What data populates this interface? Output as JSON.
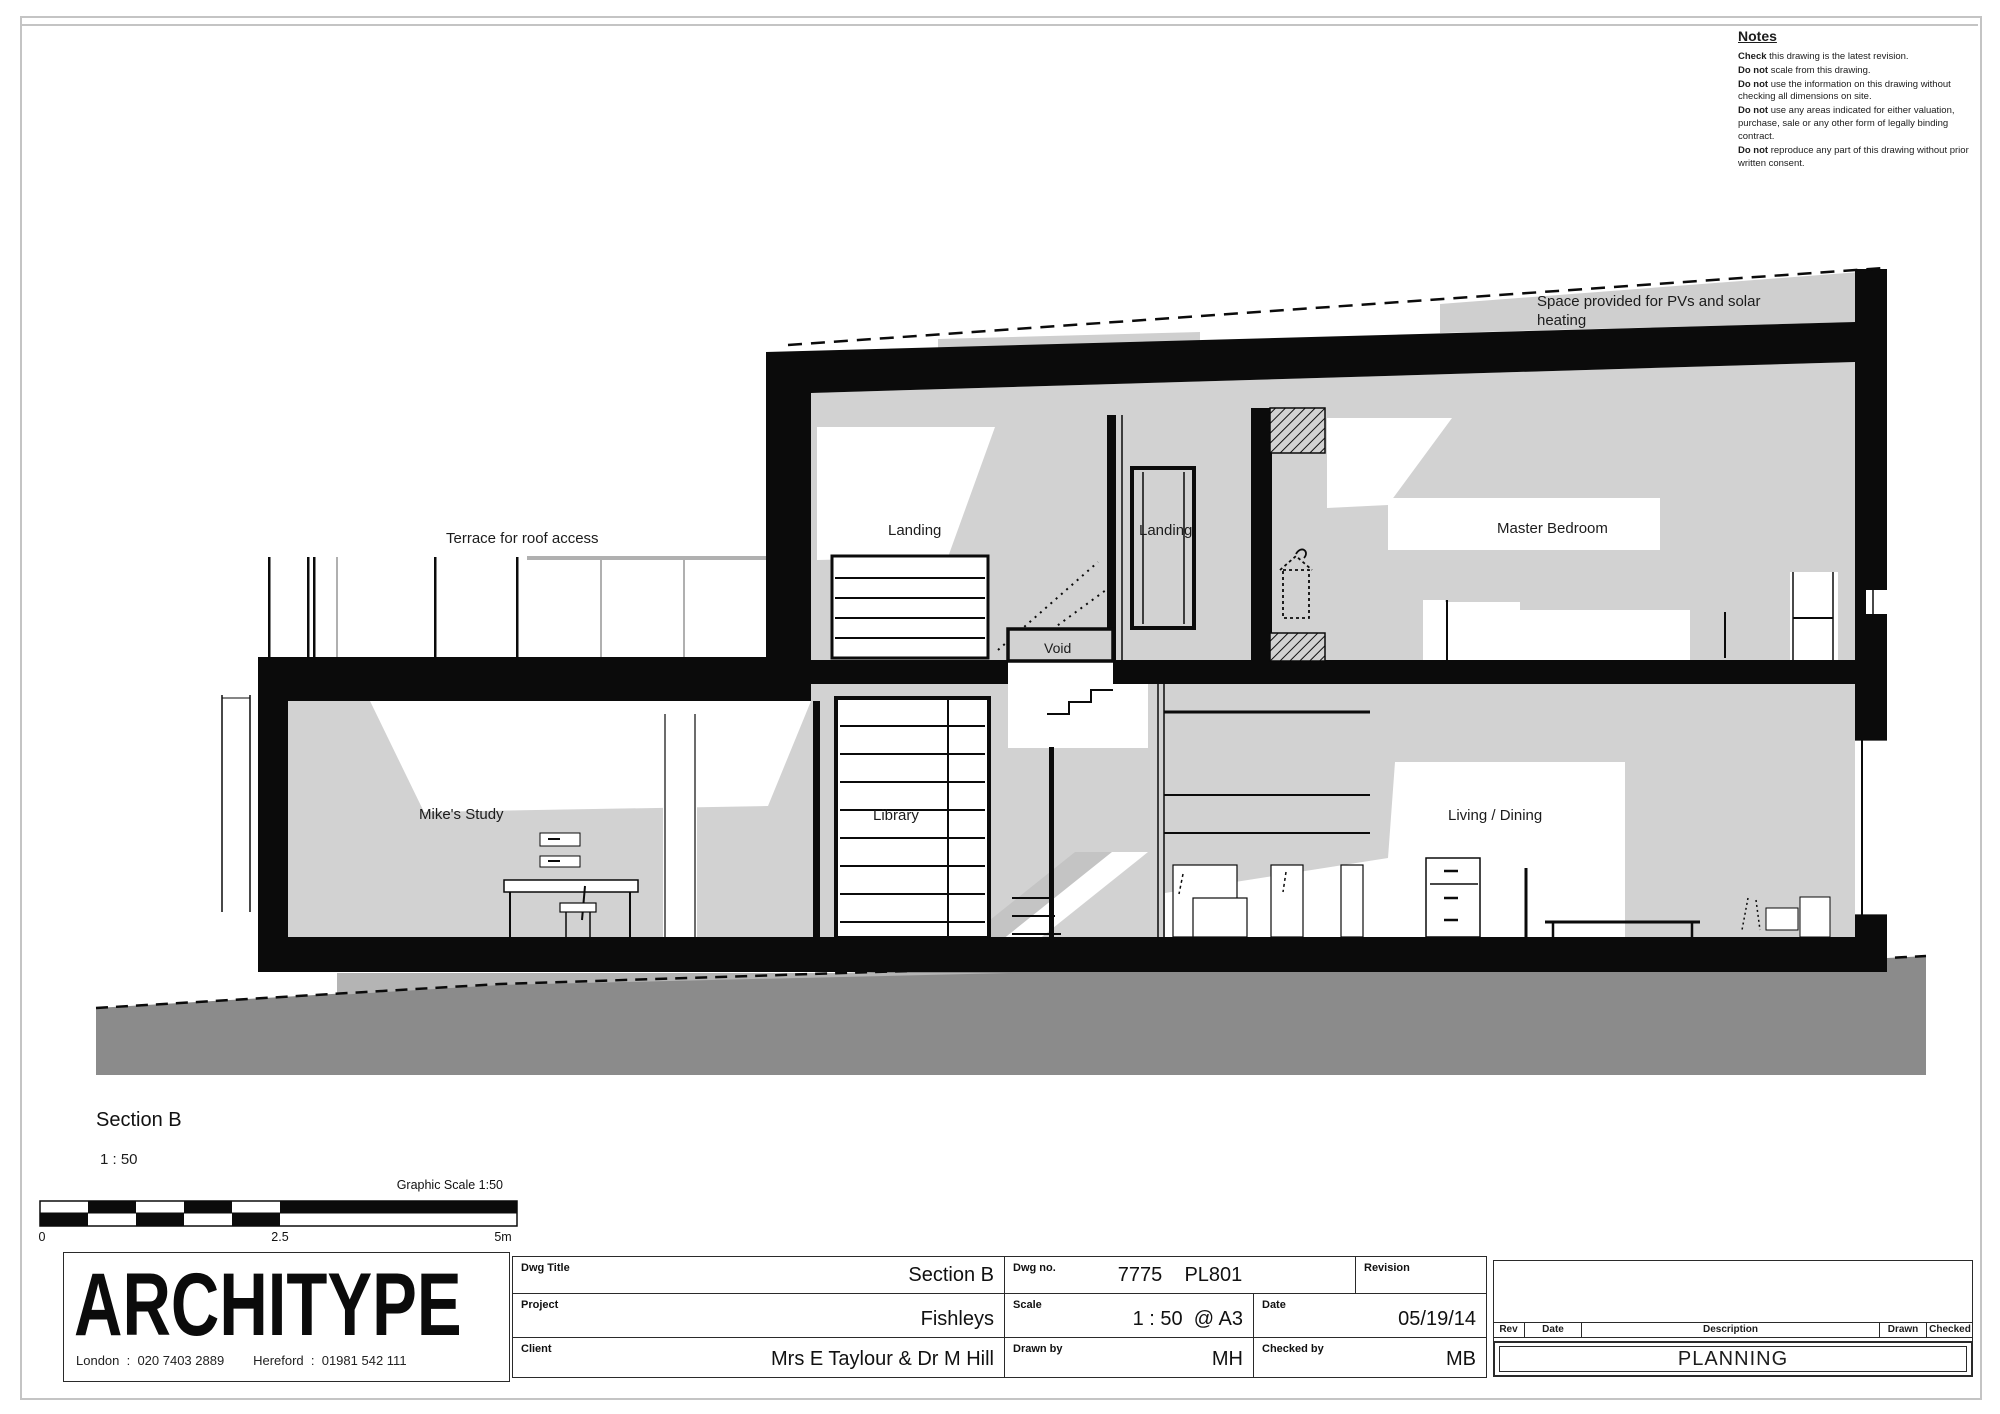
{
  "notes": {
    "title": "Notes",
    "items": [
      {
        "b": "Check",
        "t": " this drawing is the latest revision."
      },
      {
        "b": "Do not",
        "t": " scale from this drawing."
      },
      {
        "b": "Do not",
        "t": " use the information on this drawing without checking all dimensions on site."
      },
      {
        "b": "Do not",
        "t": " use any areas indicated for either valuation, purchase, sale or any other form of legally binding contract."
      },
      {
        "b": "Do not",
        "t": " reproduce any part of this drawing without prior written consent."
      }
    ]
  },
  "drawing": {
    "labels": {
      "pv_line1": "Space provided for PVs and solar",
      "pv_line2": "heating",
      "terrace": "Terrace for roof access",
      "landing_left": "Landing",
      "landing_right": "Landing",
      "master_bedroom": "Master Bedroom",
      "void": "Void",
      "mikes_study": "Mike's Study",
      "library": "Library",
      "living_dining": "Living / Dining"
    }
  },
  "section": {
    "title": "Section B",
    "scale": "1 : 50",
    "graphic_scale": "Graphic Scale 1:50",
    "bar_ticks": [
      "0",
      "2.5",
      "5m"
    ]
  },
  "firm": {
    "name": "ARCHITYPE",
    "contacts": "London  :  020 7403 2889        Hereford  :  01981 542 111"
  },
  "title_block": {
    "dwg_title": {
      "label": "Dwg Title",
      "value": "Section B"
    },
    "project": {
      "label": "Project",
      "value": "Fishleys"
    },
    "client": {
      "label": "Client",
      "value": "Mrs E Taylour & Dr M Hill"
    },
    "dwg_no": {
      "label": "Dwg no.",
      "value": "7775    PL801"
    },
    "revision": {
      "label": "Revision",
      "value": ""
    },
    "scale": {
      "label": "Scale",
      "value": "1 : 50  @ A3"
    },
    "date": {
      "label": "Date",
      "value": "05/19/14"
    },
    "drawn_by": {
      "label": "Drawn by",
      "value": "MH"
    },
    "checked_by": {
      "label": "Checked by",
      "value": "MB"
    }
  },
  "revision_table": {
    "headers": [
      "Rev",
      "Date",
      "Description",
      "Drawn",
      "Checked"
    ],
    "banner": "PLANNING"
  },
  "colors": {
    "interior_gray": "#d2d2d2",
    "ground_gray": "#8b8b8b",
    "under_building_gray": "#b4b4b4",
    "roof_zone_gray": "#cfcfcf",
    "line_black": "#0b0b0b",
    "sheet_border_gray": "#c4c4c4"
  }
}
